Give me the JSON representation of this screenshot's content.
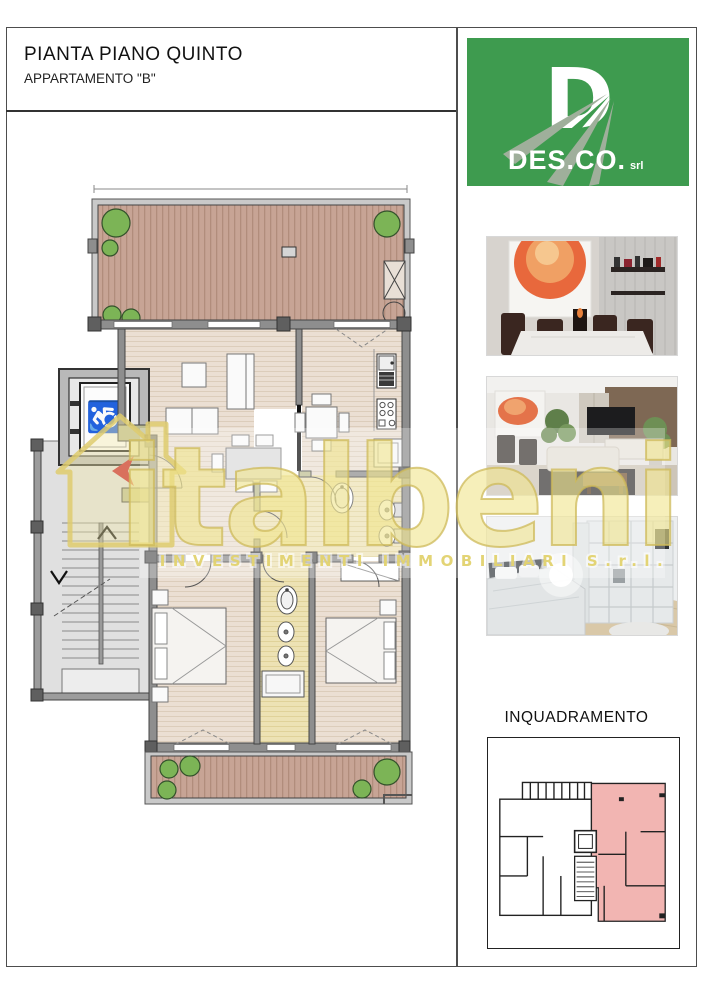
{
  "header": {
    "title": "PIANTA PIANO QUINTO",
    "subtitle": "APPARTAMENTO \"B\""
  },
  "logo": {
    "letter": "D",
    "company": "DES.CO.",
    "suffix": "srl",
    "bg_color": "#3E9B4F"
  },
  "photos": [
    {
      "name": "dining-room-render"
    },
    {
      "name": "living-room-render"
    },
    {
      "name": "bedroom-render"
    }
  ],
  "inquadramento": {
    "label": "INQUADRAMENTO",
    "highlight_color": "#F2B5B2"
  },
  "watermark": {
    "brand": "italbeni",
    "tagline": "INVESTIMENTI IMMOBILIARI S.r.l."
  },
  "icons": {
    "wheelchair": "♿"
  }
}
